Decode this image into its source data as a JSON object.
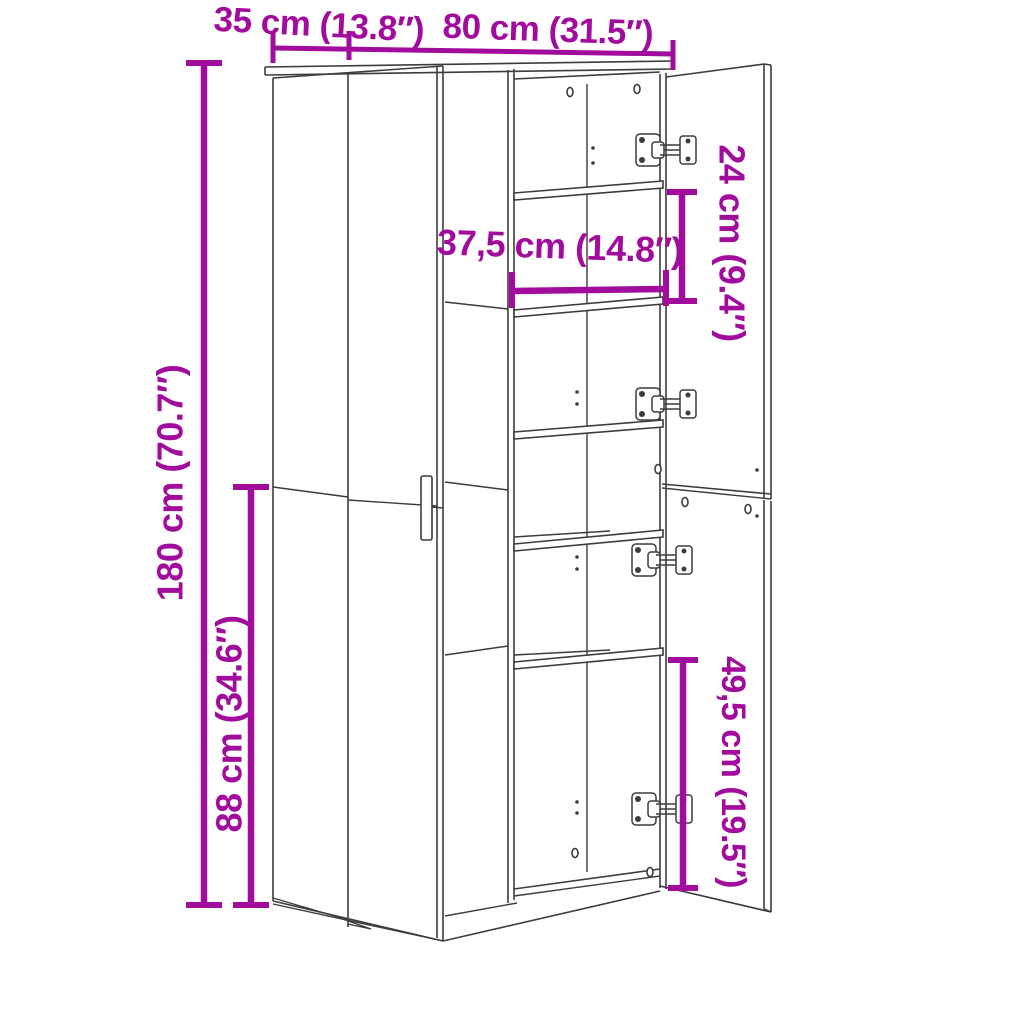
{
  "page": {
    "background": "#ffffff"
  },
  "drawing": {
    "subject": "tall two-column highboard cabinet, left doors closed with bar handle, right doors open showing five interior shelves and four hinges",
    "line_color": "#3c3c3c",
    "accent_color": "#a20c9d"
  },
  "dimensions": {
    "depth": {
      "label": "35 cm (13.8″)",
      "value_cm": "35",
      "value_in": "13.8"
    },
    "width": {
      "label": "80 cm (31.5″)",
      "value_cm": "80",
      "value_in": "31.5"
    },
    "height": {
      "label": "180 cm (70.7″)",
      "value_cm": "180",
      "value_in": "70.7"
    },
    "lower_section_height": {
      "label": "88 cm (34.6″)",
      "value_cm": "88",
      "value_in": "34.6"
    },
    "inner_width": {
      "label": "37,5 cm (14.8″)",
      "value_cm": "37,5",
      "value_in": "14.8"
    },
    "upper_compartment_height": {
      "label": "24 cm (9.4″)",
      "value_cm": "24",
      "value_in": "9.4"
    },
    "lower_compartment_height": {
      "label": "49,5 cm (19.5″)",
      "value_cm": "49,5",
      "value_in": "19.5"
    }
  }
}
